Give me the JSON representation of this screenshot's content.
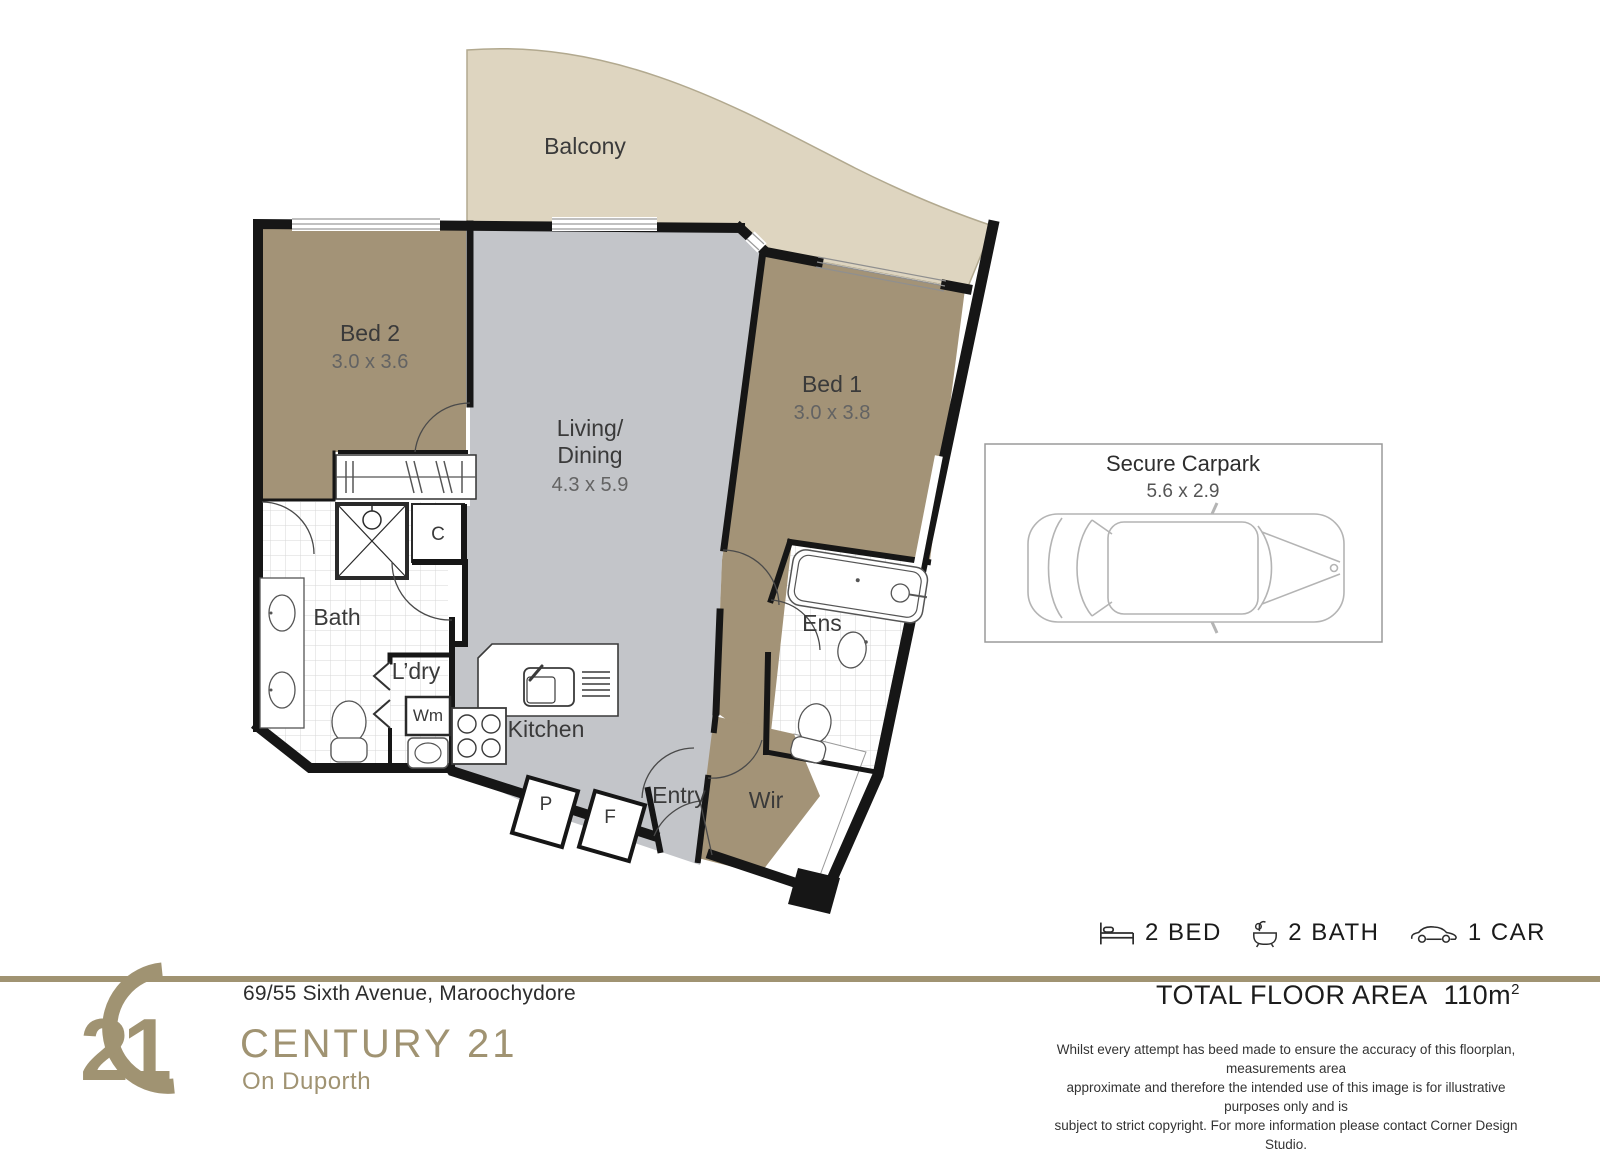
{
  "floorplan": {
    "balcony": {
      "label": "Balcony"
    },
    "rooms": {
      "bed2": {
        "label": "Bed 2",
        "dims": "3.0 x 3.6"
      },
      "bed1": {
        "label": "Bed 1",
        "dims": "3.0 x 3.8"
      },
      "living": {
        "line1": "Living/",
        "line2": "Dining",
        "dims": "4.3 x 5.9"
      },
      "bath": {
        "label": "Bath"
      },
      "ens": {
        "label": "Ens"
      },
      "laundry": {
        "label": "L’dry"
      },
      "wm": {
        "label": "Wm"
      },
      "kitchen": {
        "label": "Kitchen"
      },
      "pantry": {
        "label": "P"
      },
      "fridge": {
        "label": "F"
      },
      "entry": {
        "label": "Entry"
      },
      "wir": {
        "label": "Wir"
      },
      "closet": {
        "label": "C"
      }
    },
    "carpark": {
      "title": "Secure Carpark",
      "dims": "5.6 x 2.9"
    }
  },
  "summary": {
    "bed": "2 BED",
    "bath": "2 BATH",
    "car": "1 CAR"
  },
  "footer": {
    "address": "69/55 Sixth Avenue, Maroochydore",
    "brand": "CENTURY 21",
    "office": "On Duporth",
    "logo_numerals": "21",
    "total_area_label": "TOTAL FLOOR AREA",
    "total_area_value": "110m",
    "total_area_sup": "2",
    "disclaimer_line1": "Whilst every attempt has beed made to ensure the accuracy of this floorplan, measurements area",
    "disclaimer_line2": "approximate and therefore the intended use of this image is for illustrative purposes only and is",
    "disclaimer_line3": "subject to strict copyright. For more information please contact Corner Design Studio."
  },
  "colors": {
    "brand_gold": "#a09372",
    "room_brown": "#a39377",
    "balcony_beige": "#ded5c0",
    "living_grey": "#c3c5c9",
    "wall_black": "#161616"
  }
}
